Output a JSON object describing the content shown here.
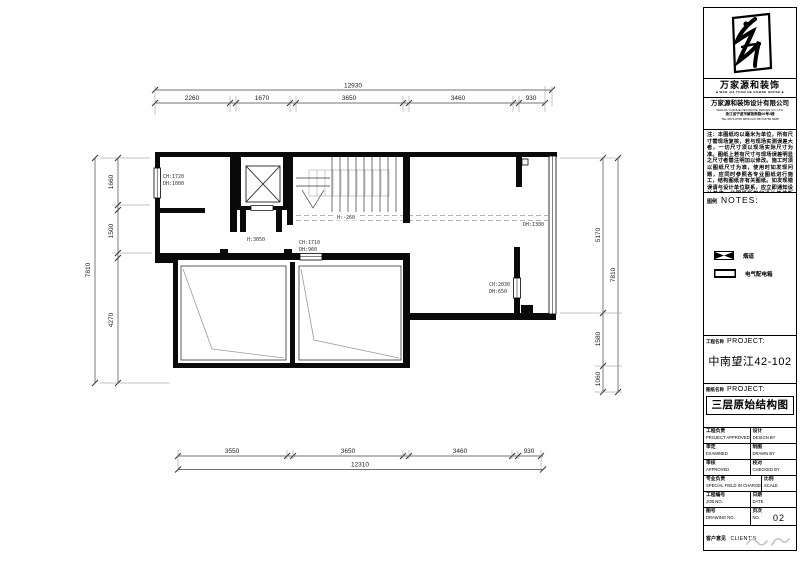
{
  "plan": {
    "dim_top": {
      "overall": "12930",
      "segments": [
        "2260",
        "1670",
        "3650",
        "3460",
        "930"
      ]
    },
    "dim_bottom": {
      "overall": "12310",
      "segments": [
        "3550",
        "3650",
        "3460",
        "930"
      ]
    },
    "dim_left": {
      "overall": "7810",
      "segments": [
        "1660",
        "1500",
        "4270"
      ]
    },
    "dim_right": {
      "overall": "7810",
      "segments": [
        "5170",
        "1580",
        "1060"
      ]
    },
    "annotations": {
      "win_left_a": "CH:1720",
      "win_left_b": "DH:1000",
      "hall_height": "H:3050",
      "win_mid_a": "CH:1710",
      "win_mid_b": "DH:960",
      "stair_level": "H:-260",
      "win_right": "DH:1300",
      "win_right2_a": "CH:2030",
      "win_right2_b": "DH:650"
    }
  },
  "titleblock": {
    "brand_zh": "万家源和装饰",
    "brand_en": "■ WAN JIA YUAN HE GOODE HOUSE ■",
    "company_zh": "万家源和装饰设计有限公司",
    "company_en": "WANJIA YUANHE DECORATE DESIGN CO.,LTD.",
    "company_addr": "浙江省宁波市解放南路66号2楼",
    "company_tel": "TEL:0574-8766 6666  FAX:0574-8766 6688",
    "notes_text": "注：本图纸均以毫米为单位，所有尺寸需现场复核，若与现场实测误差大者，一切尺寸须以现场实际尺寸为准。图纸上若有尺寸与现场误差明显之尺寸者需注明加以修改。施工时须以图纸尺寸为准，使用时如发现问题，应同时参照各专业图纸进行施工，结构图纸亦有关图纸。如发现错误请与设计单位联系，应立即通知设计单位。此图纸版权归设计单位所有。",
    "legend_zh": "图例",
    "legend_en": "NOTES:",
    "legend_items": [
      {
        "label": "烟道"
      },
      {
        "label": "电气配电箱"
      }
    ],
    "project_label_zh": "工程名称",
    "project_label_en": "PROJECT:",
    "project_name": "中南望江42-102",
    "drawing_label_zh": "图纸名称",
    "drawing_label_en": "PROJECT:",
    "drawing_name": "三层原始结构图",
    "table_rows": [
      {
        "l_zh": "工程负责",
        "l_en": "PROJECT APPROVED",
        "r_zh": "设计",
        "r_en": "DESIGN BY"
      },
      {
        "l_zh": "审定",
        "l_en": "EXAMINED",
        "r_zh": "制图",
        "r_en": "DRAWN BY"
      },
      {
        "l_zh": "审核",
        "l_en": "APPROVED",
        "r_zh": "校对",
        "r_en": "CHECKED BY"
      },
      {
        "l_zh": "专业负责",
        "l_en": "SPECIAL FIELD IN CHARGE",
        "r_zh": "比例",
        "r_en": "SCALE"
      },
      {
        "l_zh": "工程编号",
        "l_en": "JOB NO.",
        "r_zh": "日期",
        "r_en": "DATE"
      },
      {
        "l_zh": "图号",
        "l_en": "DRAWING NO.",
        "r_zh": "页次",
        "r_en": "NO."
      }
    ],
    "page_no": "02",
    "client_zh": "客户意见",
    "client_en": "CLIENT'S"
  }
}
